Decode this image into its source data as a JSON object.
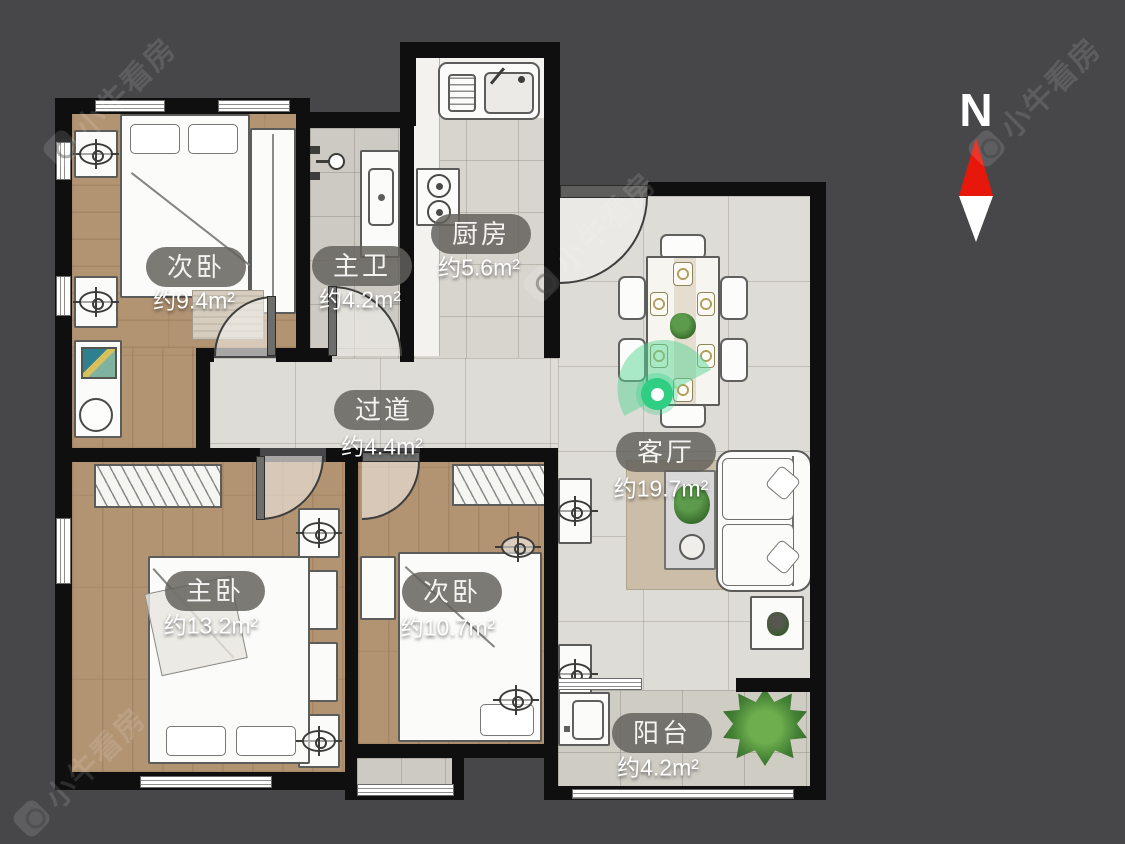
{
  "meta": {
    "background_color": "#47474a",
    "wall_color": "#0f0f0f",
    "wood_floor_color": "#b29372",
    "tile_floor_color": "#cdcac3",
    "marble_floor_color": "#dedcd7",
    "label_pill_color": "rgba(99,97,92,0.84)",
    "accent_green": "#2fce83",
    "north_arrow_red": "#e8170b"
  },
  "compass": {
    "label": "N"
  },
  "watermark": {
    "text": "小牛看房"
  },
  "rooms": [
    {
      "id": "bedroom-second-top",
      "name": "次卧",
      "area": "约9.4m²"
    },
    {
      "id": "master-bathroom",
      "name": "主卫",
      "area": "约4.2m²"
    },
    {
      "id": "kitchen",
      "name": "厨房",
      "area": "约5.6m²"
    },
    {
      "id": "hallway",
      "name": "过道",
      "area": "约4.4m²"
    },
    {
      "id": "living-room",
      "name": "客厅",
      "area": "约19.7m²"
    },
    {
      "id": "master-bedroom",
      "name": "主卧",
      "area": "约13.2m²"
    },
    {
      "id": "bedroom-second-bottom",
      "name": "次卧",
      "area": "约10.7m²"
    },
    {
      "id": "balcony",
      "name": "阳台",
      "area": "约4.2m²"
    }
  ]
}
